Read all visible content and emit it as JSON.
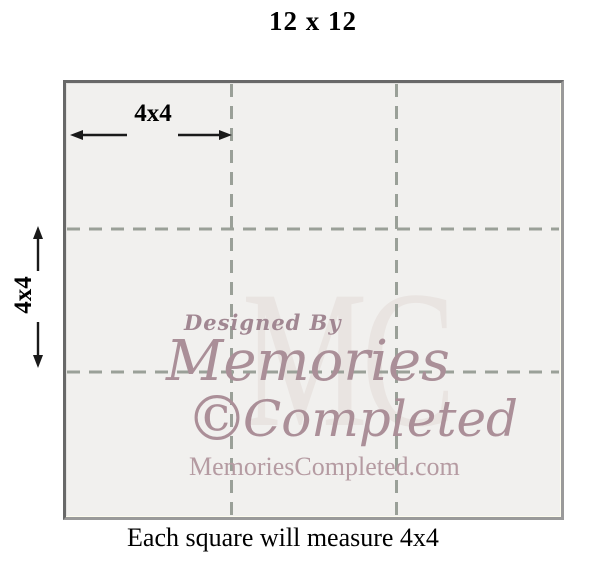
{
  "title": "12 x 12",
  "caption": "Each square will measure 4x4",
  "labels": {
    "cell_width": "4x4",
    "cell_height": "4x4"
  },
  "watermark": {
    "designed_by": "Designed By",
    "memories": "Memories",
    "copyright_symbol": "©",
    "completed": "Completed",
    "url": "MemoriesCompleted.com",
    "monogram": "MC"
  },
  "colors": {
    "grid_line": "#9aa098",
    "arrow": "#1a1a1a",
    "square_fill": "#f1f0ee",
    "square_border_dark": "#686868",
    "square_border_light": "#9a9a9a",
    "watermark_script": "#a78d96",
    "watermark_url": "#b59ba2",
    "watermark_monogram": "#e9e4e1",
    "text": "#000000"
  }
}
